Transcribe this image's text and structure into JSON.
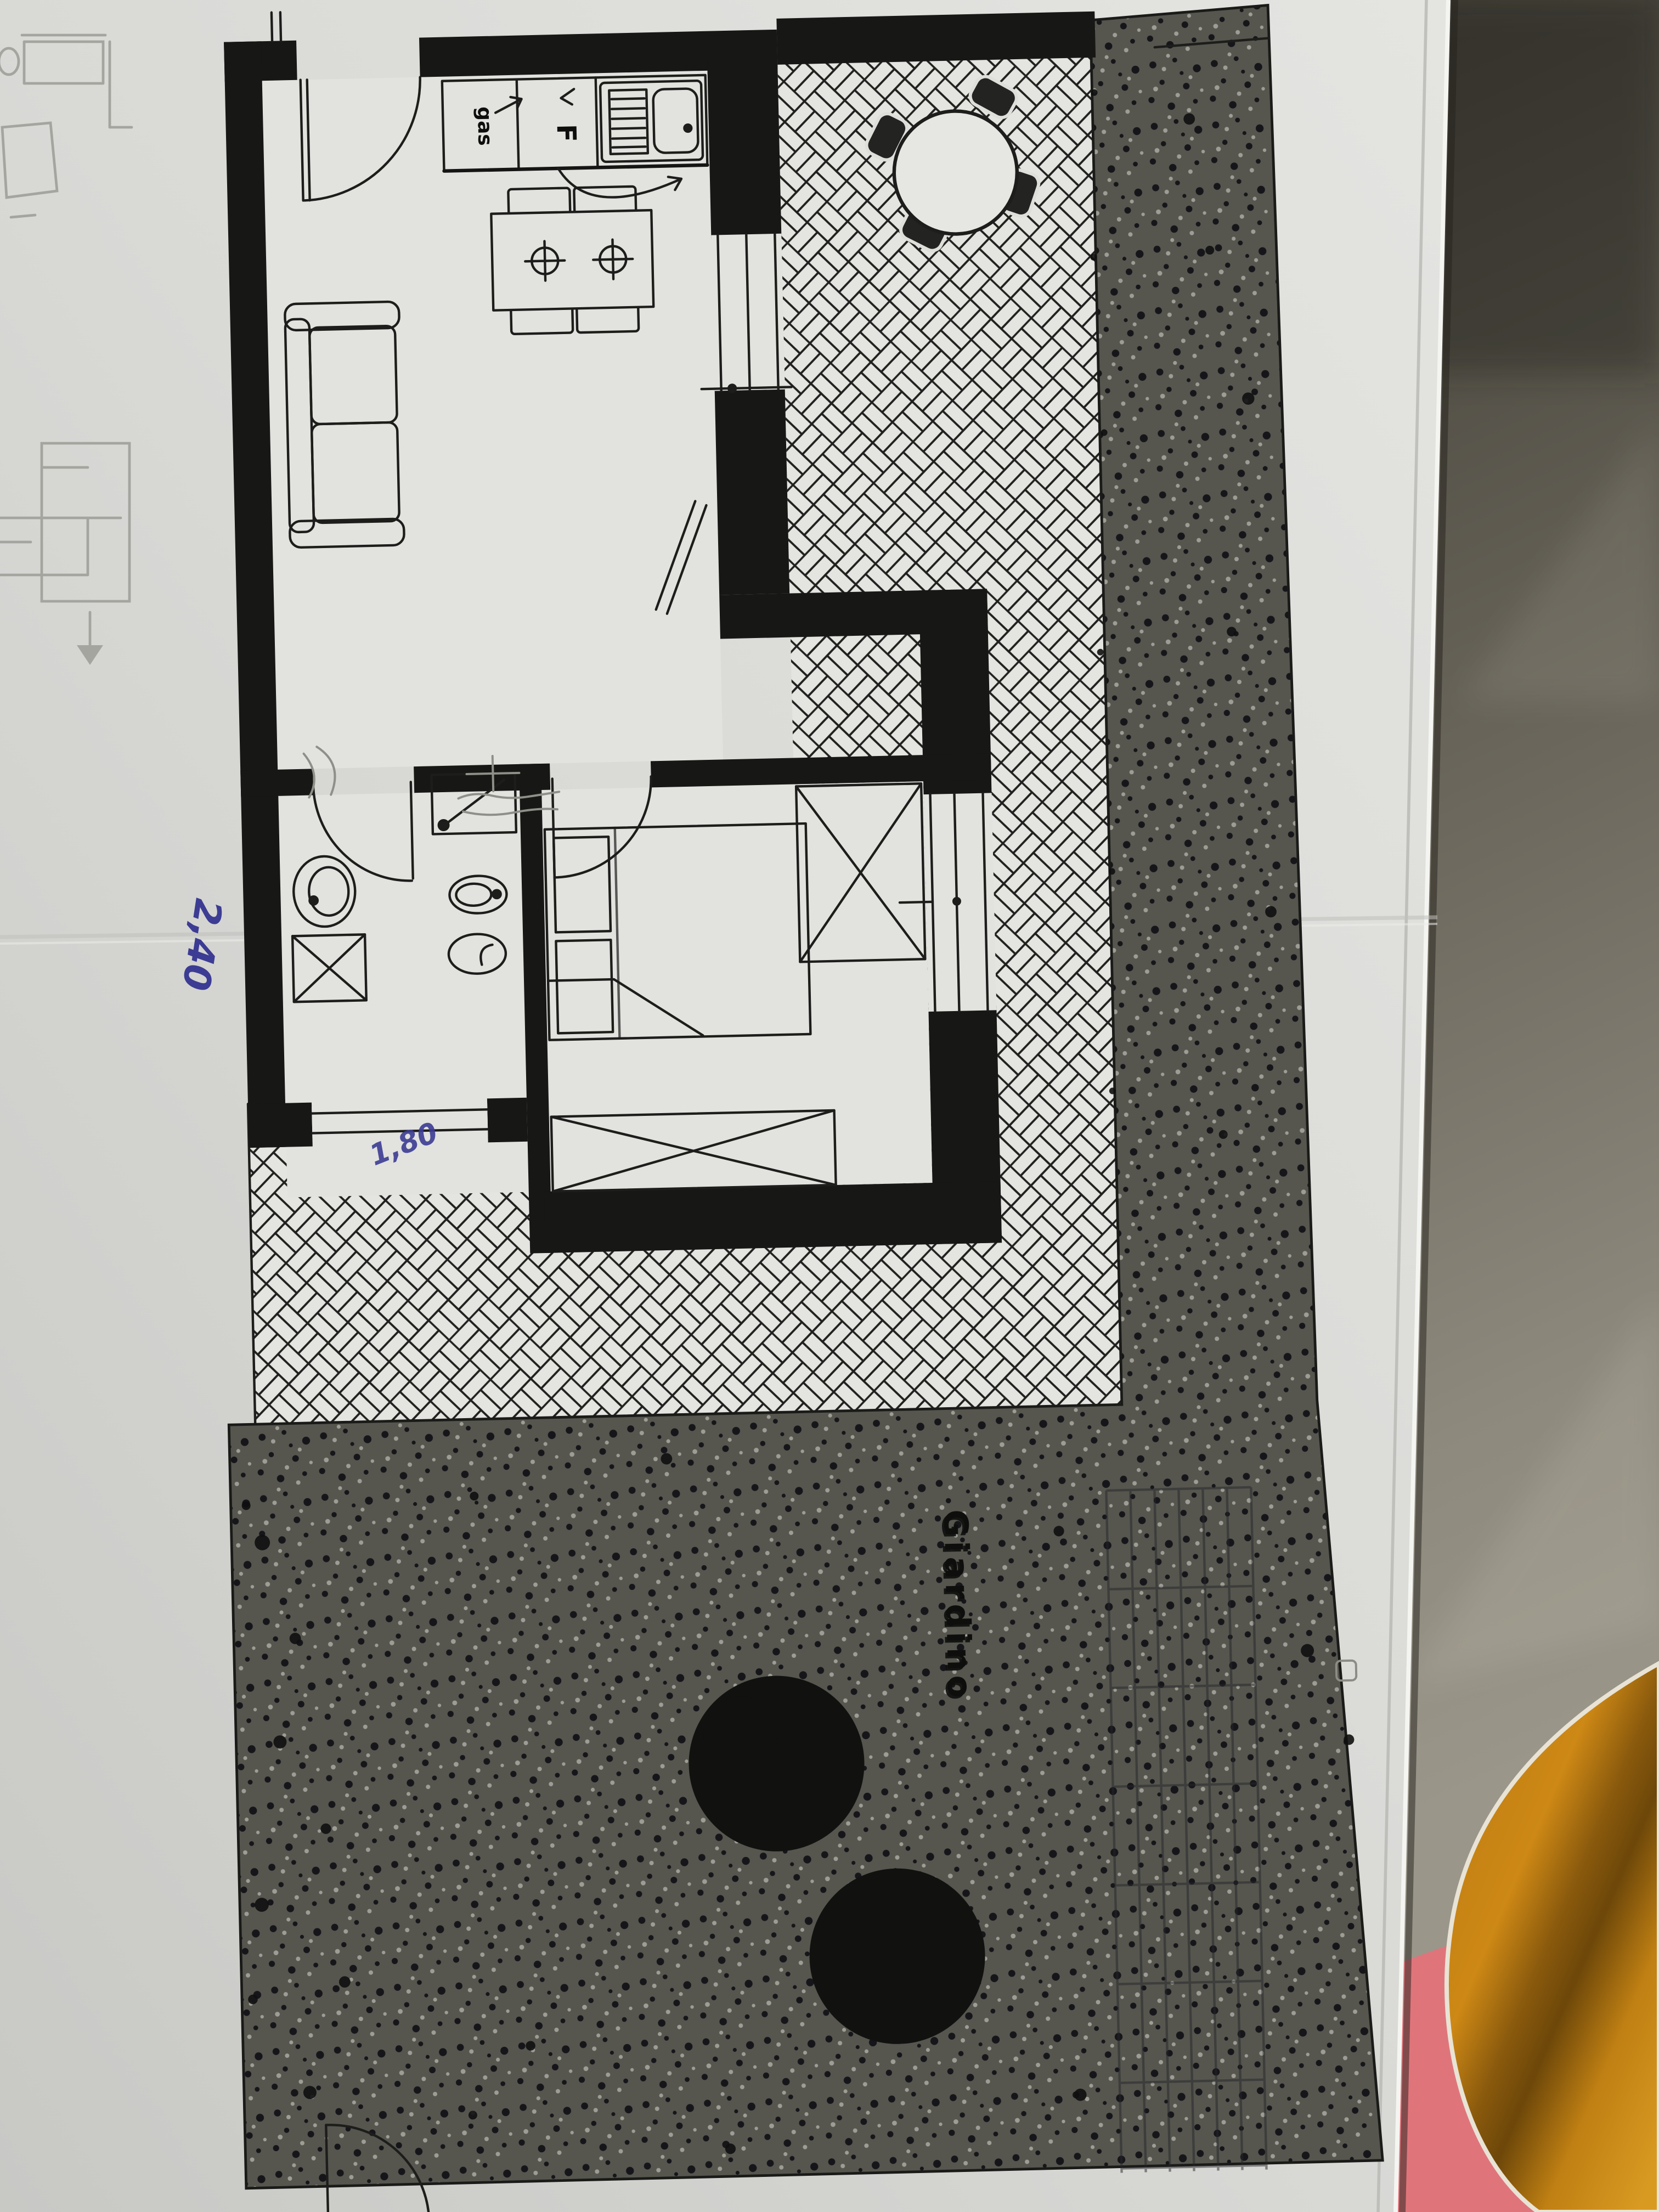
{
  "scene": {
    "description": "Photographed paper floor plan of a small apartment with patio and garden, lying on a grey tiled floor with an orange cushion at bottom right"
  },
  "plan": {
    "labels": {
      "gas": "gas",
      "fridge": "F",
      "garden": "Giardino"
    },
    "handwritten": {
      "dim_a": "2,40",
      "dim_b": "1,80"
    }
  },
  "colors": {
    "paper": "#dcdcd9",
    "plan_ink": "#1d1d1b",
    "wall_black": "#171715",
    "handwriting_blue": "#3c3c94",
    "garden_stipple": "#56564f",
    "floor_tile_dark": "#36332b",
    "floor_tile_light": "#9a968a",
    "cushion_orange": "#c98514",
    "fabric_pink": "#df757b",
    "pencil_grey": "#a5a5a0"
  }
}
